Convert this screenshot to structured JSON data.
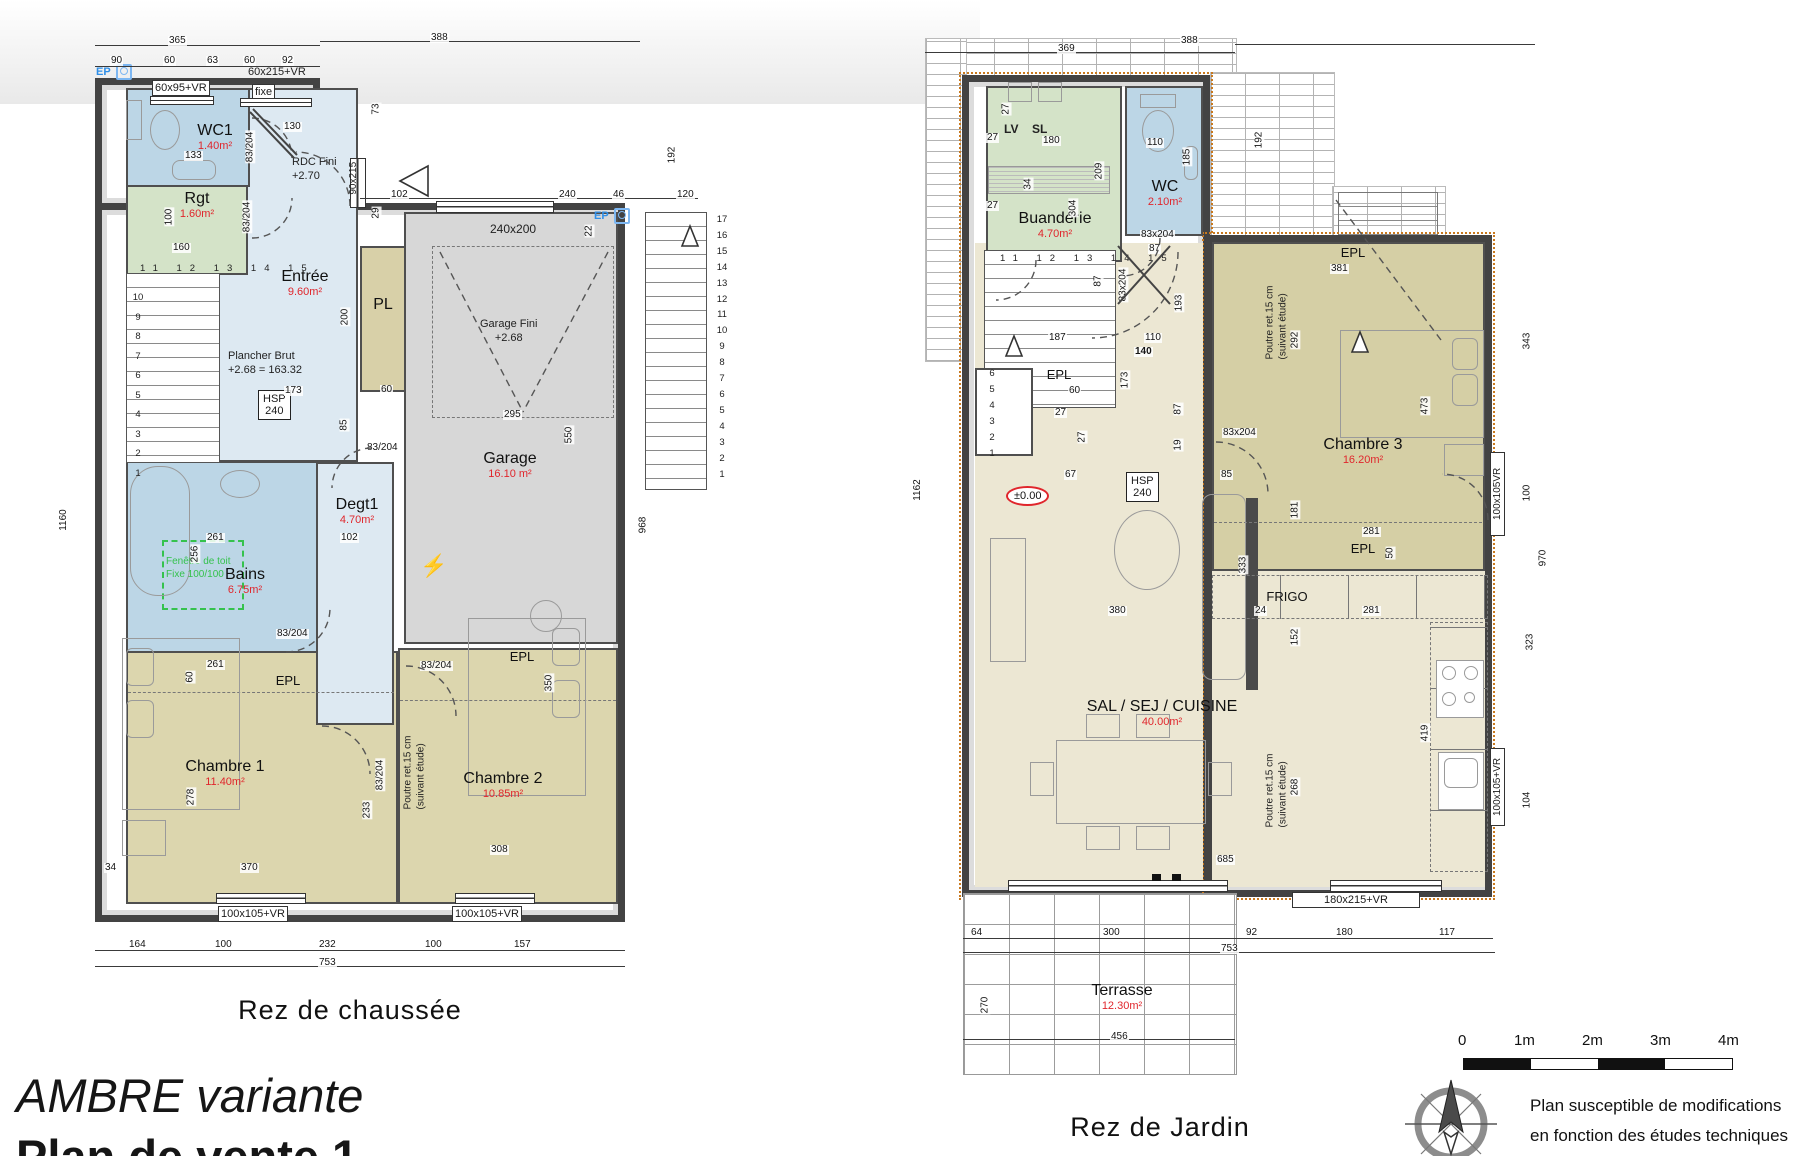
{
  "labels": {
    "ep": "EP",
    "rdc": "RDC Fini\n+2.70",
    "garage_fini": "Garage Fini\n+2.68",
    "plancher": "Plancher Brut\n+2.68 = 163.32",
    "hsp": "HSP\n240",
    "fenetre": "Fenêtre de toit\nFixe 100/100",
    "poutre": "Poutre ret.15 cm\n(suivant étude)",
    "niveau_zero": "±0.00",
    "lv": "LV",
    "sl": "SL"
  },
  "windows": {
    "w6095": "60x95+VR",
    "w60215": "60x215+VR",
    "fixe": "fixe",
    "w90215": "90x215",
    "w240200": "240x200",
    "w100105p": "100x105+VR",
    "w100105": "100x105VR",
    "w300215": "300x215VR",
    "w180215": "180x215+VR",
    "d83s": "83/204",
    "d83x": "83x204"
  },
  "dims": {
    "v365": "365",
    "v388": "388",
    "v90": "90",
    "v60": "60",
    "v63": "63",
    "v92": "92",
    "v130": "130",
    "v102": "102",
    "v240": "240",
    "v46": "46",
    "v120": "120",
    "v73": "73",
    "v29": "29",
    "v22": "22",
    "v192": "192",
    "v968": "968",
    "v1160": "1160",
    "v133": "133",
    "v100": "100",
    "v160": "160",
    "v200": "200",
    "v173": "173",
    "v85": "85",
    "v295": "295",
    "v550": "550",
    "v256": "256",
    "v261": "261",
    "v278": "278",
    "v370": "370",
    "v34": "34",
    "v233": "233",
    "v308": "308",
    "v350": "350",
    "v164": "164",
    "v232": "232",
    "v157": "157",
    "v753": "753",
    "v369": "369",
    "v1162": "1162",
    "v27": "27",
    "v180": "180",
    "v304": "304",
    "v209": "209",
    "v110": "110",
    "v185": "185",
    "v87": "87",
    "v193": "193",
    "v187": "187",
    "v140": "140",
    "v67": "67",
    "v381": "381",
    "v292": "292",
    "v473": "473",
    "v281": "281",
    "v181": "181",
    "v50": "50",
    "v24": "24",
    "v152": "152",
    "v419": "419",
    "v268": "268",
    "v333": "333",
    "v685": "685",
    "v380": "380",
    "v64": "64",
    "v300": "300",
    "v117": "117",
    "v456": "456",
    "v270": "270",
    "v343": "343",
    "v970": "970",
    "v323": "323",
    "v104": "104",
    "v19": "19"
  },
  "plan1": {
    "caption": "Rez de chaussée",
    "rooms": {
      "wc1": {
        "name": "WC1",
        "area": "1.40m²"
      },
      "rgt": {
        "name": "Rgt",
        "area": "1.60m²"
      },
      "entree": {
        "name": "Entrée",
        "area": "9.60m²"
      },
      "pl": {
        "name": "PL"
      },
      "garage": {
        "name": "Garage",
        "area": "16.10 m²"
      },
      "degt1": {
        "name": "Degt1",
        "area": "4.70m²"
      },
      "bains": {
        "name": "Bains",
        "area": "6.75m²"
      },
      "ch1": {
        "name": "Chambre 1",
        "area": "11.40m²"
      },
      "ch2": {
        "name": "Chambre 2",
        "area": "10.85m²"
      },
      "epl": "EPL"
    },
    "stairs": {
      "top": "11 12 13 14 15",
      "left": "10\n9\n8\n7\n6\n5\n4\n3\n2\n1",
      "ext": "17\n16\n15\n14\n13\n12\n11\n10\n9\n8\n7\n6\n5\n4\n3\n2\n1"
    }
  },
  "plan2": {
    "caption": "Rez de Jardin",
    "rooms": {
      "buanderie": {
        "name": "Buanderie",
        "area": "4.70m²"
      },
      "wc": {
        "name": "WC",
        "area": "2.10m²"
      },
      "ch3": {
        "name": "Chambre 3",
        "area": "16.20m²"
      },
      "sal": {
        "name": "SAL  / SEJ / CUISINE",
        "area": "40.00m²"
      },
      "terrasse": {
        "name": "Terrasse",
        "area": "12.30m²"
      },
      "epl": "EPL",
      "frigo": "FRIGO"
    },
    "stairs": {
      "top": "11 12 13 14 15",
      "left": "6\n5\n4\n3\n2\n1",
      "ext": "6\n5\n4\n3\n2\n1"
    }
  },
  "footer": {
    "title": "AMBRE variante",
    "subtitle": "Plan de vente 1",
    "disclaimer1": "Plan susceptible de modifications",
    "disclaimer2": "en fonction des études techniques",
    "scale": {
      "s0": "0",
      "s1": "1m",
      "s2": "2m",
      "s3": "3m",
      "s4": "4m"
    }
  }
}
